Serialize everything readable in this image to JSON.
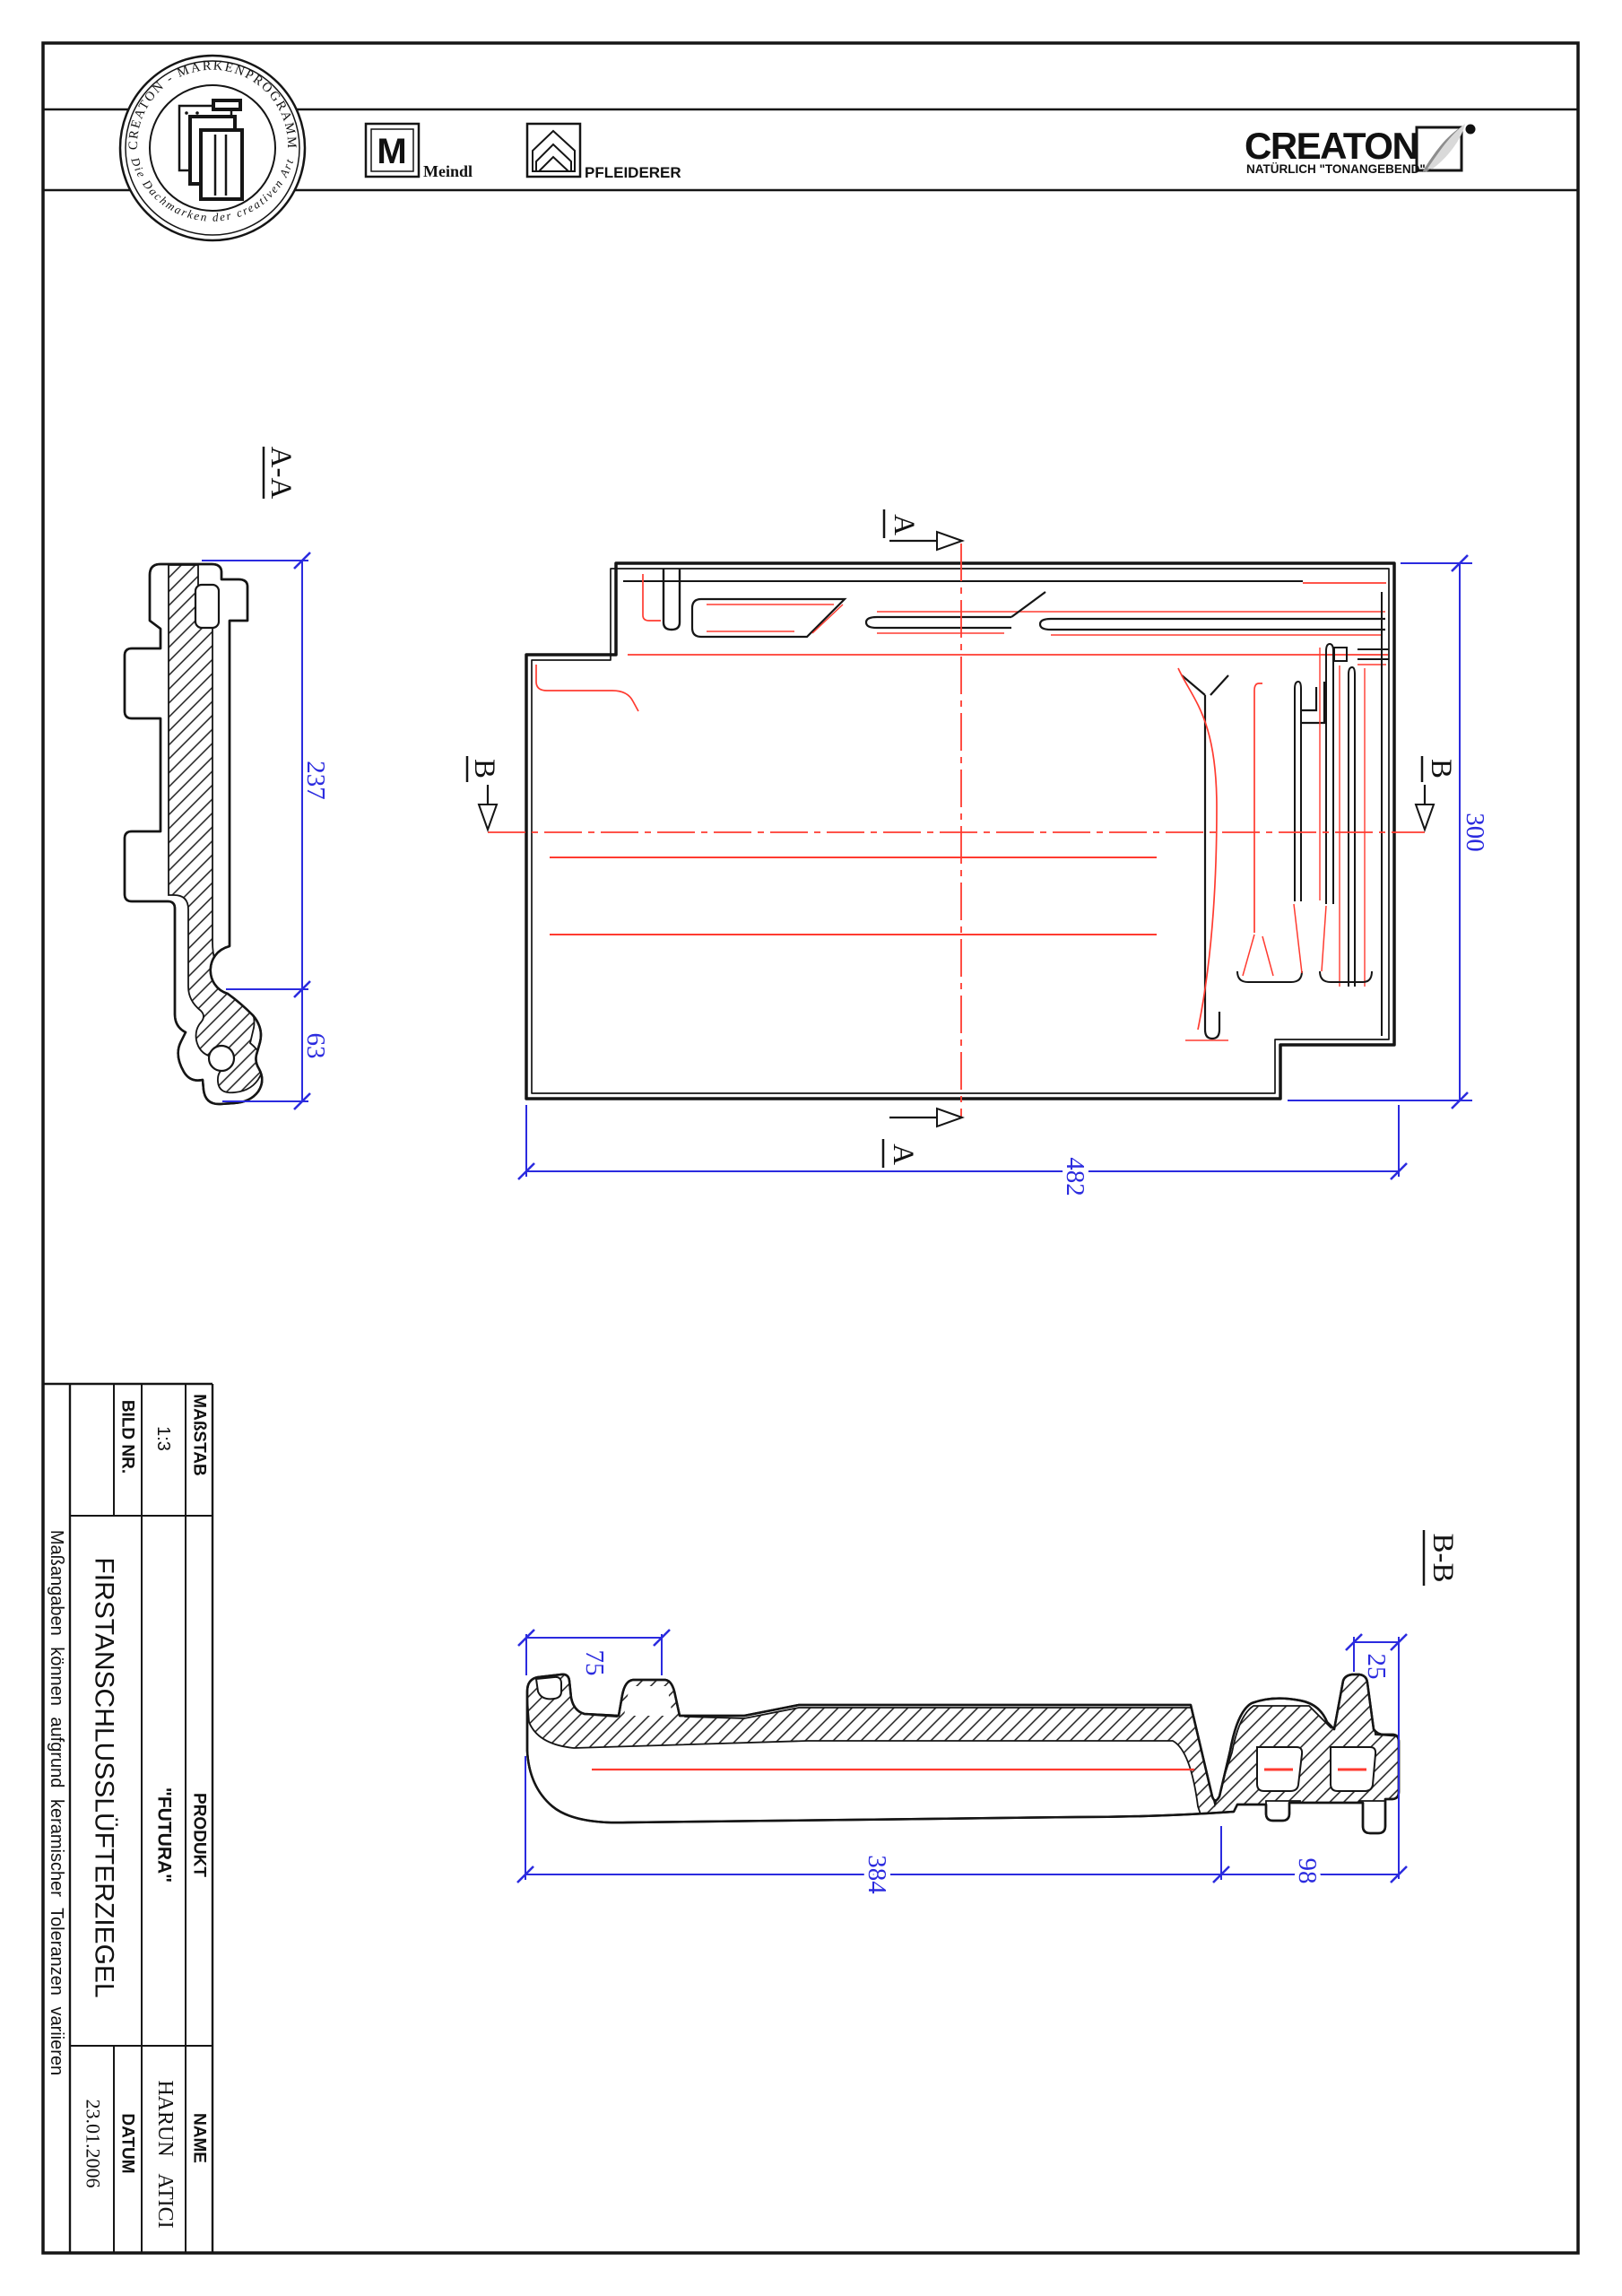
{
  "header": {
    "badge": {
      "top_arc": "CREATON - MARKENPROGRAMM",
      "bottom_arc": "Die Dachmarken der creativen Art"
    },
    "meindl": {
      "monogram": "M",
      "label": "Meindl"
    },
    "pfleiderer": {
      "label": "PFLEIDERER"
    },
    "creaton": {
      "wordmark": "CREATON",
      "tagline": "NATÜRLICH \"TONANGEBEND\""
    }
  },
  "views": {
    "section_aa": {
      "label": "A-A",
      "dim_height": "237",
      "dim_hook": "63"
    },
    "plan": {
      "marker_a": "A",
      "marker_b": "B",
      "dim_length": "482",
      "dim_width": "300"
    },
    "section_bb": {
      "label": "B-B",
      "dim_left": "75",
      "dim_right": "25",
      "dim_main": "384",
      "dim_side": "98"
    }
  },
  "title_block": {
    "masstab_label": "MAßSTAB",
    "masstab_value": "1:3",
    "bild_label": "BILD NR.",
    "produkt_label": "PRODUKT",
    "produkt_value": "\"FUTURA\"",
    "product_name": "FIRSTANSCHLUSSLÜFTERZIEGEL",
    "name_label": "NAME",
    "name_value": "HARUN ATICI",
    "datum_label": "DATUM",
    "datum_value": "23.01.2006",
    "note": "Maßangaben können aufgrund keramischer Toleranzen variieren"
  },
  "colors": {
    "ink": "#151515",
    "dimension": "#2b2bdf",
    "centerline": "#ff3b30"
  }
}
